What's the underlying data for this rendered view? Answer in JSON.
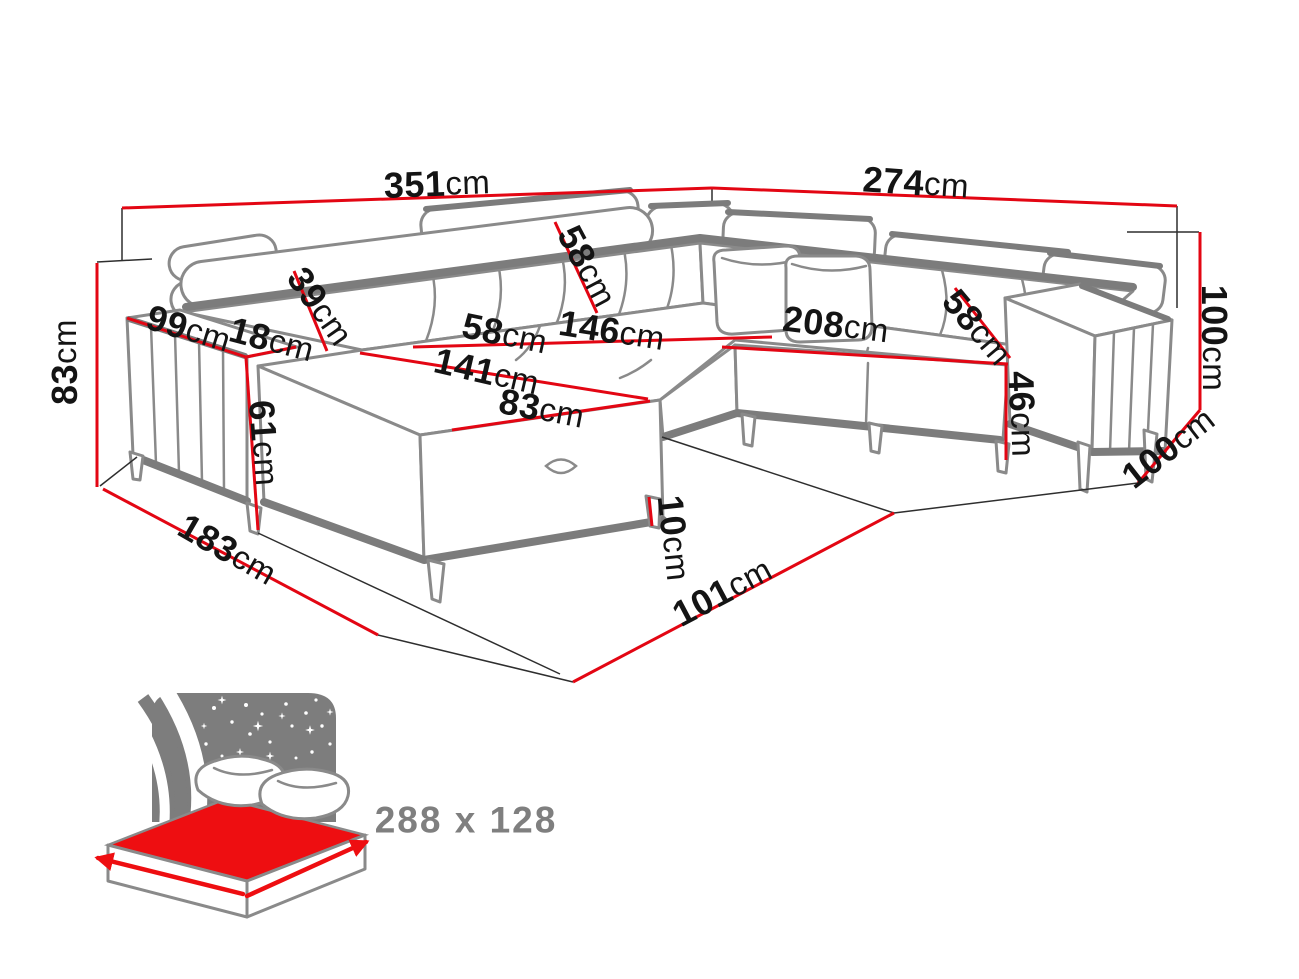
{
  "meta": {
    "type": "furniture-dimension-diagram",
    "subject": "U-shaped corner sofa bed technical drawing with dimensions",
    "unit": "cm"
  },
  "colors": {
    "dimension_red": "#e30613",
    "sketch_gray": "#8a8a8a",
    "sketch_dark_gray": "#7c7c7c",
    "label_black": "#141414",
    "icon_gray": "#7d7d7d",
    "icon_red": "#ee0e11",
    "icon_text_gray": "#7f7f7f",
    "background": "#ffffff"
  },
  "dimensions": [
    {
      "id": "wall-side-left-width",
      "value": "351",
      "unit": "cm"
    },
    {
      "id": "wall-side-right-width",
      "value": "274",
      "unit": "cm"
    },
    {
      "id": "left-side-height",
      "value": "83",
      "unit": "cm"
    },
    {
      "id": "right-side-height",
      "value": "100",
      "unit": "cm"
    },
    {
      "id": "left-arm-section-depth",
      "value": "99",
      "unit": "cm"
    },
    {
      "id": "left-arm-top-width",
      "value": "18",
      "unit": "cm"
    },
    {
      "id": "backrest-depth",
      "value": "39",
      "unit": "cm"
    },
    {
      "id": "back-cushion-height",
      "value": "58",
      "unit": "cm"
    },
    {
      "id": "seat-depth-left",
      "value": "58",
      "unit": "cm"
    },
    {
      "id": "left-seat-width",
      "value": "146",
      "unit": "cm"
    },
    {
      "id": "chaise-length",
      "value": "141",
      "unit": "cm"
    },
    {
      "id": "chaise-width",
      "value": "83",
      "unit": "cm"
    },
    {
      "id": "right-seat-width",
      "value": "208",
      "unit": "cm"
    },
    {
      "id": "seat-depth-right",
      "value": "58",
      "unit": "cm"
    },
    {
      "id": "seat-height",
      "value": "46",
      "unit": "cm"
    },
    {
      "id": "left-arm-front-height",
      "value": "61",
      "unit": "cm"
    },
    {
      "id": "left-side-depth",
      "value": "183",
      "unit": "cm"
    },
    {
      "id": "leg-height",
      "value": "10",
      "unit": "cm"
    },
    {
      "id": "front-floor-depth",
      "value": "101",
      "unit": "cm"
    },
    {
      "id": "right-side-depth",
      "value": "100",
      "unit": "cm"
    }
  ],
  "sleeping_area": {
    "label": "288 x 128",
    "icon": "sofa-bed-sleeping-surface-icon"
  }
}
